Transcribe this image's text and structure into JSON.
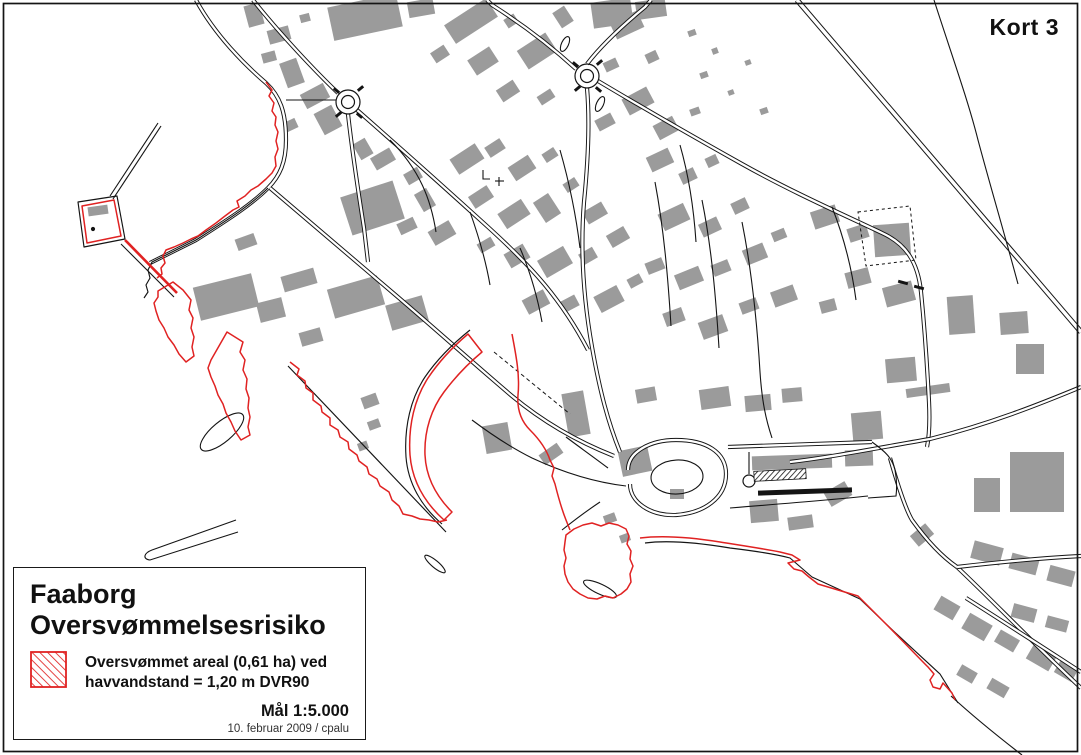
{
  "title": {
    "label": "Kort 3"
  },
  "legend": {
    "title_lines": [
      "Faaborg",
      "Oversvømmelsesrisiko"
    ],
    "item": {
      "line1": "Oversvømmet areal (0,61 ha) ved",
      "line2": "havvandstand = 1,20 m DVR90"
    },
    "scale": "Mål 1:5.000",
    "credit": "10. februar 2009 / cpalu"
  },
  "colors": {
    "line": "#141414",
    "building": "#9b9b9b",
    "flood": "#e02222",
    "background": "#ffffff"
  },
  "map": {
    "buildings": [
      [
        246,
        4,
        16,
        22,
        -15
      ],
      [
        268,
        28,
        22,
        14,
        -15
      ],
      [
        262,
        52,
        14,
        10,
        -15
      ],
      [
        283,
        60,
        18,
        26,
        -20
      ],
      [
        300,
        14,
        10,
        8,
        -15
      ],
      [
        330,
        0,
        70,
        34,
        -12
      ],
      [
        408,
        0,
        26,
        16,
        -10
      ],
      [
        302,
        88,
        26,
        16,
        -28
      ],
      [
        318,
        108,
        20,
        24,
        -28
      ],
      [
        285,
        120,
        12,
        10,
        -25
      ],
      [
        356,
        140,
        14,
        18,
        -30
      ],
      [
        372,
        152,
        22,
        14,
        -30
      ],
      [
        345,
        188,
        55,
        40,
        -18
      ],
      [
        405,
        170,
        16,
        12,
        -30
      ],
      [
        418,
        190,
        14,
        20,
        -30
      ],
      [
        398,
        220,
        18,
        12,
        -25
      ],
      [
        430,
        225,
        24,
        16,
        -30
      ],
      [
        236,
        236,
        20,
        12,
        -20
      ],
      [
        196,
        280,
        60,
        34,
        -14
      ],
      [
        258,
        300,
        26,
        20,
        -14
      ],
      [
        282,
        272,
        34,
        16,
        -16
      ],
      [
        330,
        282,
        52,
        30,
        -16
      ],
      [
        388,
        300,
        38,
        26,
        -16
      ],
      [
        300,
        330,
        22,
        14,
        -16
      ],
      [
        446,
        10,
        50,
        22,
        -33
      ],
      [
        432,
        48,
        16,
        12,
        -33
      ],
      [
        470,
        52,
        26,
        18,
        -33
      ],
      [
        505,
        16,
        12,
        10,
        -33
      ],
      [
        520,
        40,
        34,
        22,
        -33
      ],
      [
        498,
        84,
        20,
        14,
        -33
      ],
      [
        538,
        92,
        16,
        10,
        -33
      ],
      [
        556,
        8,
        14,
        18,
        -33
      ],
      [
        612,
        16,
        30,
        18,
        -25
      ],
      [
        646,
        52,
        12,
        10,
        -25
      ],
      [
        604,
        60,
        14,
        10,
        -25
      ],
      [
        624,
        92,
        28,
        18,
        -28
      ],
      [
        596,
        116,
        18,
        12,
        -28
      ],
      [
        655,
        120,
        22,
        16,
        -28
      ],
      [
        688,
        30,
        8,
        6,
        -20
      ],
      [
        712,
        48,
        6,
        6,
        -20
      ],
      [
        700,
        72,
        8,
        6,
        -20
      ],
      [
        728,
        90,
        6,
        5,
        -20
      ],
      [
        745,
        60,
        6,
        5,
        -20
      ],
      [
        760,
        108,
        8,
        6,
        -20
      ],
      [
        690,
        108,
        10,
        7,
        -20
      ],
      [
        592,
        0,
        40,
        26,
        -8
      ],
      [
        636,
        0,
        30,
        18,
        -8
      ],
      [
        452,
        150,
        30,
        18,
        -33
      ],
      [
        486,
        142,
        18,
        12,
        -33
      ],
      [
        510,
        160,
        24,
        16,
        -33
      ],
      [
        543,
        150,
        14,
        10,
        -33
      ],
      [
        470,
        190,
        22,
        14,
        -33
      ],
      [
        500,
        205,
        28,
        18,
        -33
      ],
      [
        538,
        196,
        18,
        24,
        -33
      ],
      [
        564,
        180,
        14,
        10,
        -33
      ],
      [
        584,
        206,
        22,
        14,
        -30
      ],
      [
        478,
        240,
        16,
        10,
        -30
      ],
      [
        506,
        248,
        22,
        16,
        -30
      ],
      [
        540,
        252,
        30,
        20,
        -30
      ],
      [
        580,
        250,
        16,
        12,
        -30
      ],
      [
        608,
        230,
        20,
        14,
        -30
      ],
      [
        524,
        294,
        24,
        16,
        -28
      ],
      [
        560,
        298,
        18,
        12,
        -28
      ],
      [
        596,
        290,
        26,
        18,
        -28
      ],
      [
        628,
        276,
        14,
        10,
        -28
      ],
      [
        648,
        152,
        24,
        16,
        -25
      ],
      [
        680,
        170,
        16,
        12,
        -25
      ],
      [
        706,
        156,
        12,
        10,
        -25
      ],
      [
        660,
        208,
        28,
        18,
        -25
      ],
      [
        700,
        220,
        20,
        14,
        -25
      ],
      [
        732,
        200,
        16,
        12,
        -25
      ],
      [
        646,
        260,
        18,
        12,
        -22
      ],
      [
        676,
        270,
        26,
        16,
        -22
      ],
      [
        712,
        262,
        18,
        12,
        -22
      ],
      [
        744,
        246,
        22,
        16,
        -22
      ],
      [
        772,
        230,
        14,
        10,
        -22
      ],
      [
        664,
        310,
        20,
        14,
        -20
      ],
      [
        700,
        318,
        26,
        18,
        -20
      ],
      [
        740,
        300,
        18,
        12,
        -20
      ],
      [
        772,
        288,
        24,
        16,
        -20
      ],
      [
        812,
        208,
        26,
        18,
        -18
      ],
      [
        848,
        226,
        20,
        14,
        -18
      ],
      [
        874,
        224,
        36,
        32,
        -4
      ],
      [
        846,
        270,
        24,
        16,
        -15
      ],
      [
        884,
        284,
        30,
        20,
        -15
      ],
      [
        820,
        300,
        16,
        12,
        -15
      ],
      [
        948,
        296,
        26,
        38,
        -4
      ],
      [
        1000,
        312,
        28,
        22,
        -4
      ],
      [
        1016,
        344,
        28,
        30,
        0
      ],
      [
        886,
        358,
        30,
        24,
        -5
      ],
      [
        906,
        386,
        44,
        9,
        -8
      ],
      [
        852,
        412,
        30,
        28,
        -5
      ],
      [
        565,
        392,
        22,
        44,
        -10
      ],
      [
        620,
        448,
        30,
        26,
        -12
      ],
      [
        670,
        489,
        14,
        10,
        0
      ],
      [
        636,
        388,
        20,
        14,
        -10
      ],
      [
        700,
        388,
        30,
        20,
        -8
      ],
      [
        745,
        395,
        26,
        16,
        -5
      ],
      [
        782,
        388,
        20,
        14,
        -5
      ],
      [
        752,
        455,
        80,
        14,
        -2
      ],
      [
        845,
        450,
        28,
        16,
        -2
      ],
      [
        750,
        500,
        28,
        22,
        -5
      ],
      [
        788,
        516,
        25,
        13,
        -8
      ],
      [
        826,
        486,
        24,
        16,
        -30
      ],
      [
        362,
        395,
        16,
        12,
        -20
      ],
      [
        368,
        420,
        12,
        9,
        -20
      ],
      [
        358,
        442,
        10,
        8,
        -20
      ],
      [
        484,
        424,
        26,
        28,
        -10
      ],
      [
        540,
        448,
        22,
        12,
        -35
      ],
      [
        88,
        206,
        20,
        9,
        -8
      ],
      [
        1010,
        452,
        54,
        60,
        0
      ],
      [
        974,
        478,
        26,
        34,
        0
      ],
      [
        912,
        528,
        20,
        14,
        -40
      ],
      [
        972,
        544,
        30,
        18,
        15
      ],
      [
        1010,
        556,
        28,
        16,
        15
      ],
      [
        1048,
        568,
        26,
        16,
        15
      ],
      [
        936,
        600,
        22,
        16,
        30
      ],
      [
        964,
        618,
        26,
        18,
        30
      ],
      [
        996,
        634,
        22,
        14,
        30
      ],
      [
        1028,
        650,
        26,
        16,
        30
      ],
      [
        1056,
        664,
        20,
        14,
        30
      ],
      [
        1012,
        606,
        24,
        14,
        15
      ],
      [
        1046,
        618,
        22,
        12,
        15
      ],
      [
        958,
        668,
        18,
        12,
        30
      ],
      [
        988,
        682,
        20,
        12,
        30
      ],
      [
        604,
        514,
        12,
        9,
        -20
      ],
      [
        620,
        534,
        10,
        8,
        -20
      ]
    ],
    "roads_double": [
      "M196,0 C215,35 245,65 266,83 C280,96 286,112 286,140 C286,162 280,176 268,188 C250,206 224,222 196,240 L150,263",
      "M253,0 C280,34 316,72 338,93",
      "M357,110 C398,146 444,187 488,227 C532,267 562,300 588,350",
      "M270,188 C310,222 352,258 392,292 C432,326 472,362 512,396 C542,421 576,441 614,456",
      "M348,114 C352,150 358,190 364,228 L368,262",
      "M587,64 C600,47 622,26 645,7 L651,0",
      "M576,69 C552,47 522,24 492,5 L487,0",
      "M587,88 C590,122 588,162 584,202 C580,252 584,302 592,347 C600,392 608,422 620,452",
      "M598,81 C640,106 692,136 742,164 C792,192 842,214 882,233 C906,244 918,262 921,292 C924,322 927,362 929,402 C930,422 929,437 927,447",
      {
        "d": "M797,0 L1081,332",
        "ow": 5.4,
        "iw": 3.4
      },
      "M790,462 C832,457 872,449 930,439 C990,424 1040,404 1081,387",
      "M890,458 C898,486 905,508 912,520 C930,545 944,558 957,567",
      "M957,567 C992,600 1030,640 1081,688",
      "M957,567 C1000,562 1042,558 1081,556",
      "M966,598 C1004,622 1044,648 1081,672",
      "M728,447 L872,442",
      "M628,470 C628,452 650,440 676,440 C706,440 726,452 726,474 C726,498 704,513 676,515 C650,516 630,502 630,484"
    ],
    "roads_single": [
      "M286,100 L336,100",
      "M390,140 C420,170 431,200 436,232",
      "M470,212 C480,240 486,262 490,285",
      "M520,248 C532,276 538,300 542,322",
      "M560,150 C570,185 576,215 580,248",
      "M655,182 C664,230 668,278 671,326",
      "M702,200 C712,250 716,300 719,348",
      "M742,222 C752,272 757,322 760,372 C762,402 766,420 772,438",
      "M680,145 C690,180 694,212 696,242",
      "M832,207 C845,240 852,270 856,300",
      "M934,0 C950,50 968,100 978,140 C990,185 1004,232 1018,284",
      "M749,452 L749,474",
      "M730,508 C780,504 830,500 868,496",
      "M872,442 C886,452 892,458 895,470 C897,480 897,488 896,496 L868,498",
      "M626,486 C592,482 562,472 532,458 C508,446 488,432 472,420",
      "M600,502 C585,512 572,522 562,530",
      "M608,468 C592,456 578,446 566,437",
      "M483,170 L483,179 L490,179",
      "M495,181 L504,181",
      "M499,177 L499,186",
      "M158,123 L110,196",
      "M161,126 L113,199",
      "M121,244 L174,297",
      "M236,520 L152,550 C144,553 142,559 150,560 L238,532"
    ],
    "coast": [
      "M268,188 C250,206 224,222 196,240 L152,262 L148,270 L150,278 L146,285 L148,292 L144,298",
      "M78,202 L117,196 L125,239 L84,247 Z",
      "M288,366 L446,532",
      "M470,330 C455,342 438,358 425,377 C411,398 404,426 406,457 C408,483 421,506 442,524",
      "M645,543 C668,540 700,543 730,548 C755,551 775,554 790,558 L812,577 L860,599 L884,622 C905,642 925,660 940,674 L958,703",
      "M951,696 C975,718 1000,738 1022,755"
    ],
    "flood": [
      "M266,82 l6,8 -3,6 5,7 -2,8 4,6 -1,8 3,7 -2,9 2,8 -3,8 1,9 -4,7 -6,6 -8,7 -7,4 -6,6 -8,5 2,6 -6,3 -8,6 -9,7 -10,7 -8,6 -7,3 -8,4 -9,4 -8,3 -3,6 2,7 -4,5 1,6 -5,4",
      "M82,206 L114,200 L121,236 L87,243 Z",
      {
        "d": "M125,240 L177,293",
        "w": 2.6
      },
      "M158,291 l15,-9 10,8 8,10 -2,10 4,8 -2,10 3,9 -2,10 2,9 -8,6 -7,-8 -5,-9 -6,-8 -4,-9 -5,-8 -3,-9 -2,-8 4,-6 Z",
      "M227,332 l16,10 -3,10 5,8 -2,10 4,9 -1,10 3,9 -1,10 2,9 -2,10 2,8 -9,5 -6,-9 -4,-9 -5,-9 -3,-9 -5,-9 -3,-9 -4,-9 -3,-9 3,-8 4,-7 Z",
      "M290,362 l9,7 -2,6 8,6 1,7 7,5 0,7 8,6 1,6 8,6 0,7 8,5 2,7 8,5 1,7 8,6 2,6 8,6 2,7 8,5 3,7 9,6 3,8 7,6 4,8 9,2 8,3 9,1 9,2 9,-2",
      "M468,334 C455,345 440,360 428,378 C415,398 408,425 410,455 C412,480 424,502 444,520 L452,512 C436,496 426,477 425,455 C424,430 432,408 444,392 C456,376 470,362 482,352 Z",
      "M512,334 C516,355 520,375 518,395 C517,408 520,420 530,430 C538,438 546,448 550,460 L554,468 L552,476 L555,484 C558,496 562,510 566,520 L570,530",
      "M566,535 l8,-6 9,-4 9,-2 9,3 8,-3 9,2 8,4 3,7 -2,8 4,7 -1,8 3,7 -3,8 1,8 -4,7 -6,5 -8,4 -8,-2 -8,3 -9,-1 -8,-4 -7,-5 -5,-7 -3,-8 -1,-8 2,-8 -2,-8 1,-8 Z",
      "M640,538 C665,535 695,538 720,542 C745,546 765,549 780,552 l12,3 8,5 -12,3 6,6 8,2 7,6 9,7 L858,596 L880,618 C900,638 915,654 928,667 l6,7 -4,6 3,7 7,2 3,-6 9,10 L955,700"
    ],
    "circles": [
      [
        348,
        102,
        12,
        0
      ],
      [
        348,
        102,
        6.5,
        0
      ],
      [
        587,
        76,
        12,
        0
      ],
      [
        587,
        76,
        6.5,
        0
      ],
      [
        749,
        481,
        6,
        0
      ],
      [
        93,
        229,
        1.5,
        1
      ]
    ],
    "ellipses": [
      [
        222,
        432,
        27,
        10,
        -40
      ],
      [
        435,
        564,
        13,
        3.5,
        40
      ],
      [
        600,
        589,
        18,
        5,
        25
      ],
      [
        565,
        44,
        3.5,
        8,
        25
      ],
      [
        600,
        104,
        3.5,
        8,
        25
      ],
      [
        677,
        477,
        26,
        17,
        -3
      ]
    ],
    "bars": [
      [
        898,
        281,
        10,
        3,
        15
      ],
      [
        914,
        286,
        10,
        3,
        15
      ],
      [
        758,
        489,
        94,
        5,
        -2
      ],
      [
        333,
        89,
        7,
        3,
        40
      ],
      [
        357,
        87,
        7,
        3,
        -40
      ],
      [
        335,
        113,
        7,
        3,
        -40
      ],
      [
        356,
        114,
        7,
        3,
        40
      ],
      [
        572,
        63,
        7,
        3,
        40
      ],
      [
        596,
        61,
        7,
        3,
        -40
      ],
      [
        574,
        87,
        7,
        3,
        -40
      ],
      [
        595,
        88,
        7,
        3,
        40
      ]
    ],
    "hatch": [
      [
        754,
        470,
        52,
        10,
        -3
      ]
    ],
    "dashed": [
      {
        "d": "M494,352 L570,414",
        "dash": "4,3"
      },
      {
        "d": "M858,212 L910,206 L916,260 L866,266 Z",
        "dash": "3,3"
      }
    ]
  }
}
